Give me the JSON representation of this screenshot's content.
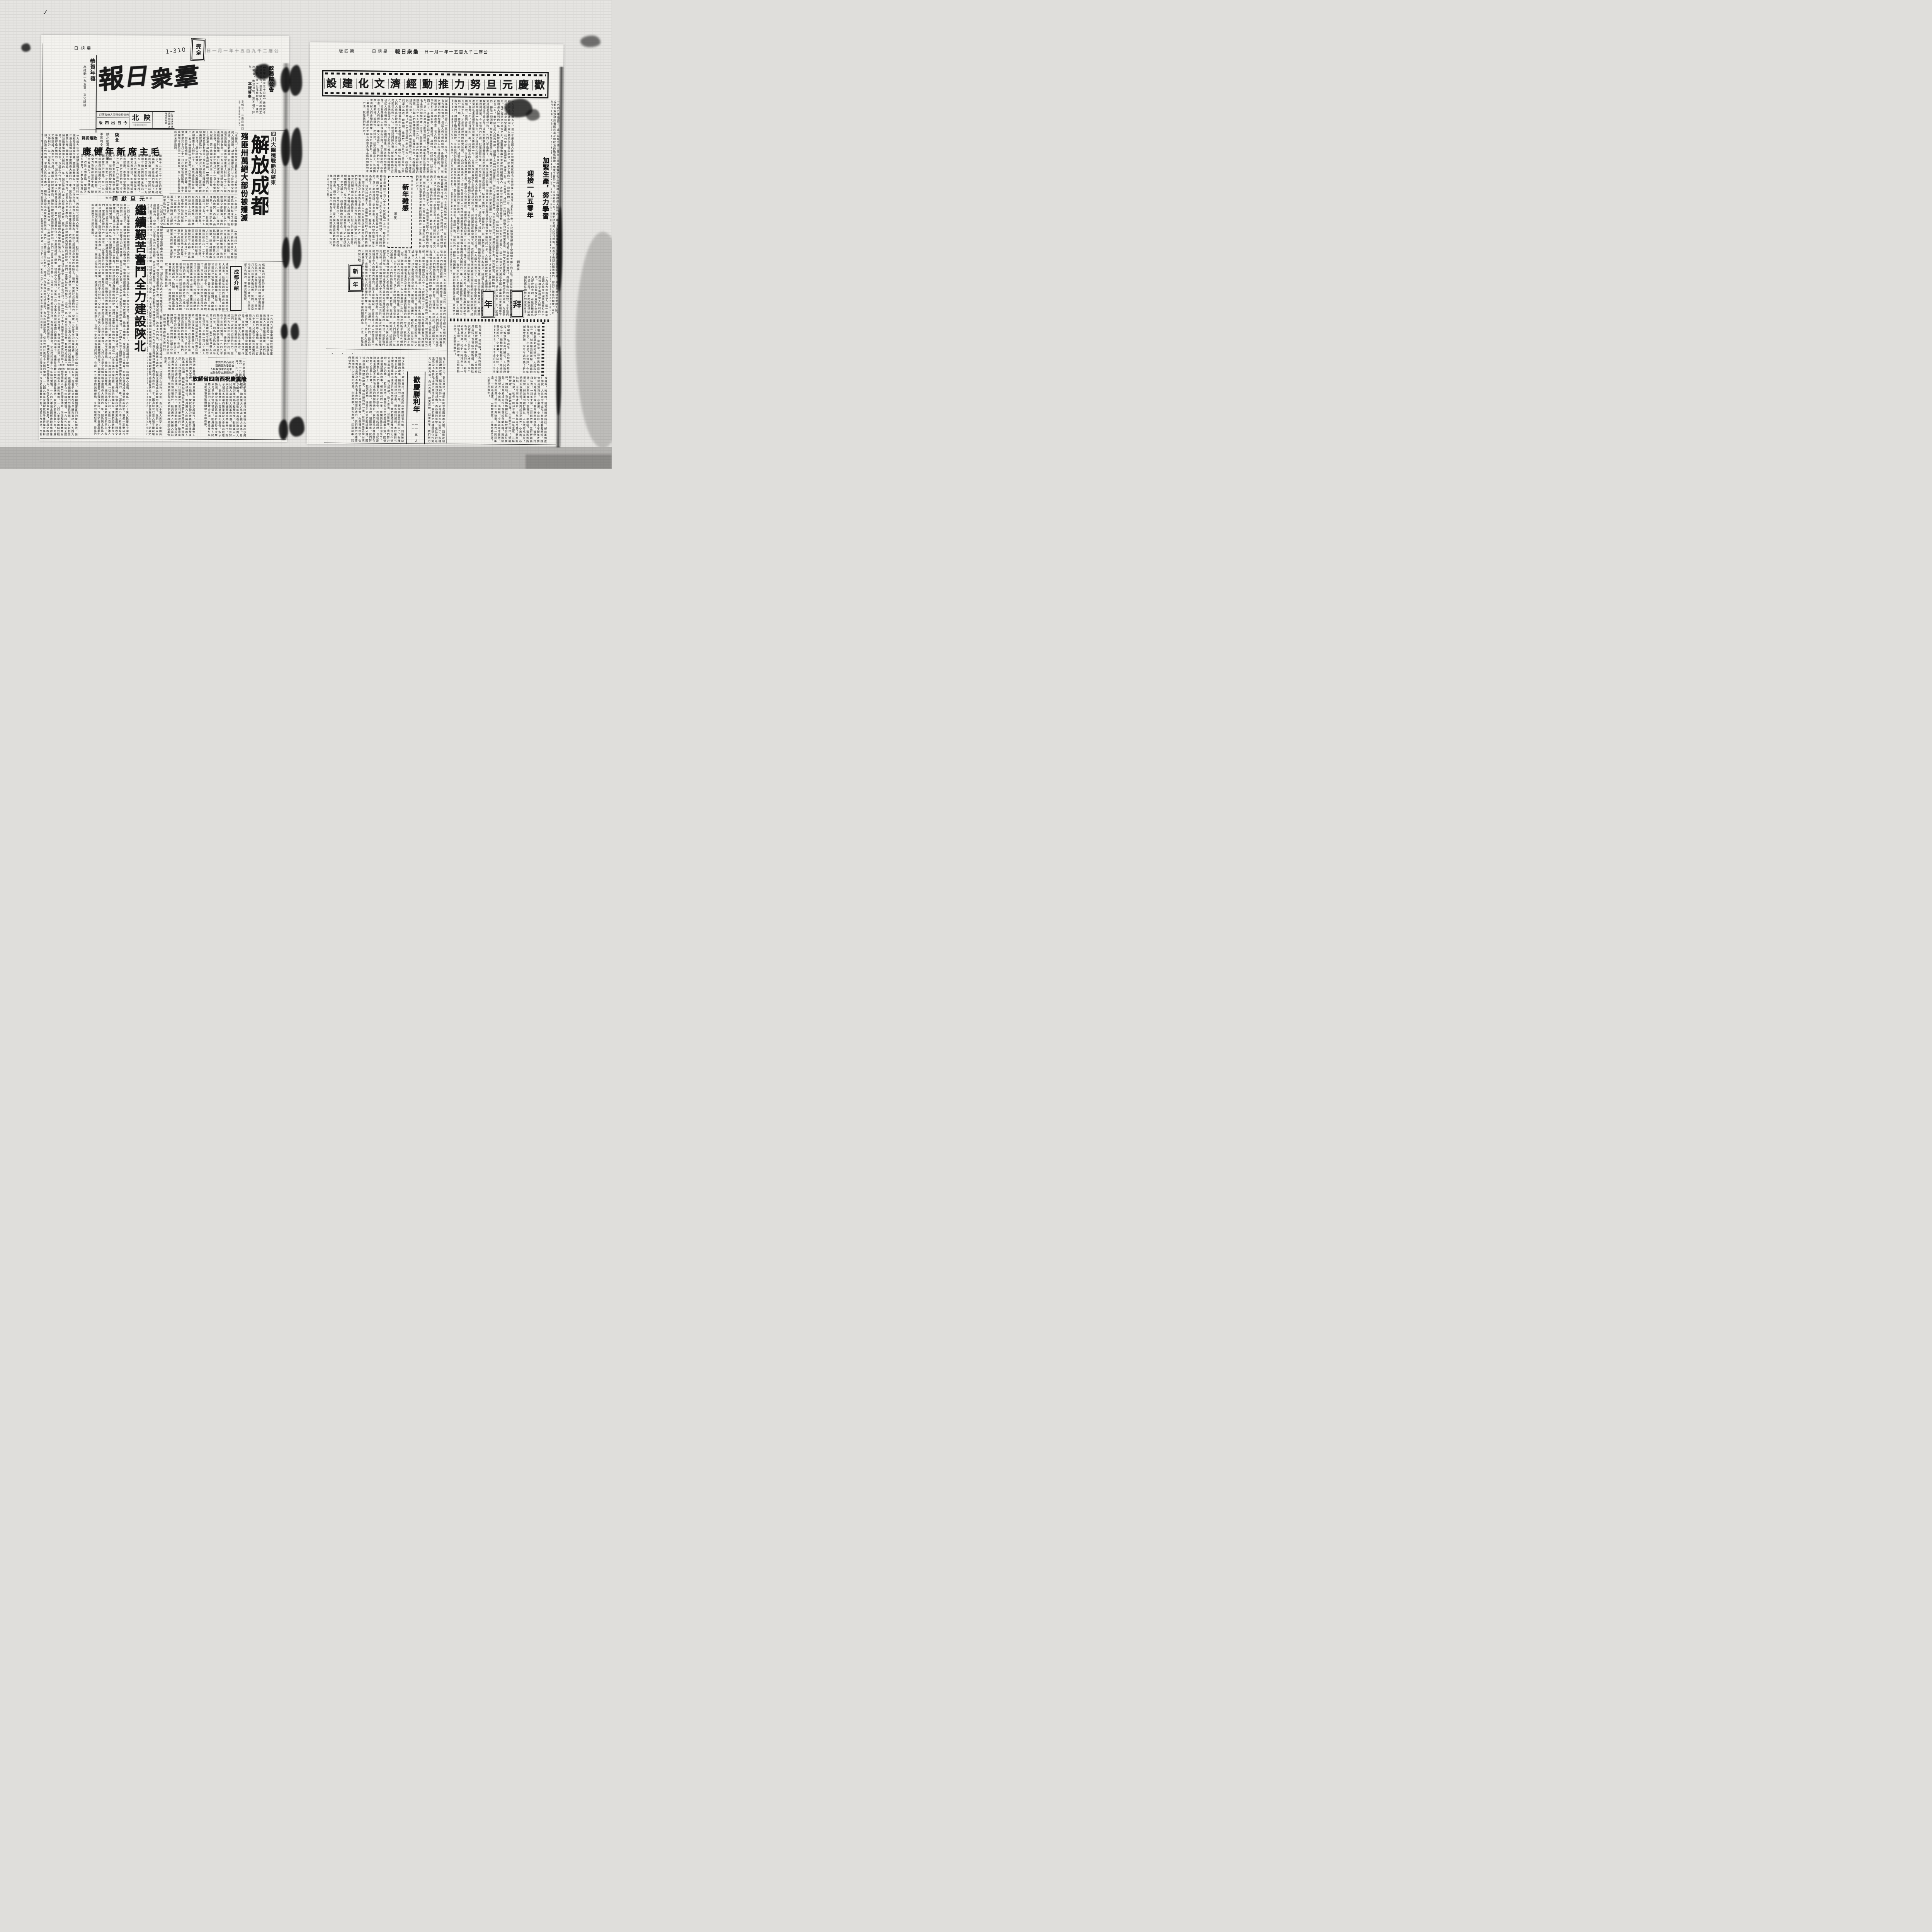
{
  "scan_marks": {
    "handwriting": "1-310",
    "stamp": "完全",
    "weekday": "星期日",
    "date_faint": "公曆二千九百五十年一月一日",
    "corner_mark": "✓",
    "cross_marks": "×　×　×"
  },
  "right_header": {
    "edition": "第四版",
    "weekday": "星期日",
    "paper": "羣衆日報",
    "date": "公曆二千九百五十年一月一日"
  },
  "masthead": {
    "title": "羣衆日報",
    "price": "訂價每份人民幣叁拾伍元",
    "edition_note": "今日出四版",
    "region": "陝北",
    "region_sub": "（羣衆日報社）",
    "info": "訂閱及廣告費另照郵局轉各地郵局辦理"
  },
  "greeting": {
    "line1": "恭賀年禧",
    "line2": "為推動一九五零、文化建設"
  },
  "gov_notice": {
    "title": "政務院公告",
    "body": "【新華社北京三十日電】政務院今日發佈公告，規定各級人民政府工作人員，在元旦除放假外，一律不許宴會，收送禮物，並不相互拜年。"
  },
  "paper_notice": {
    "title": "本報啓事",
    "body": "本報三、二兩日共四版，四日照常出版。"
  },
  "chengdu": {
    "kicker": "四川大圍殲戰勝利結束",
    "subtitle": "殘匪卅萬絕大部份被殲滅",
    "headline": "解放成都",
    "body": "【本報訊】人民解放軍已勝利結束了成都地區的大殲滅戰。胡宗南匪部已於廿七日被我全部殲滅，第四野戰軍一部沿川康公路向雅安、西昌方面進擊，匪首胡宗南本人則於二十三日乘飛機逃往台北。二十五日我軍開始總攻擊，西南戰役勝利結束，即日解放成都。守敵紛紛放下武器，裴昌會率部於本月二十一日在金堂地區起義，第十兵團司令部及四十一軍軍長、四十七軍軍長與所部全部投誠。"
  },
  "chengdu_intro": {
    "title": "成都介紹",
    "body": "成都是四川省的省會，西南著名的大城市。匪留在四川的胡宗南匪部及其他國民黨部隊約三十萬，自本月九日以來先後起義、投誠，川南地區國民黨軍基本上被殲，西康南部亦告解放，雲南光復在即。"
  },
  "mao_greeting": {
    "org1": "陝北區黨委、行署",
    "org2": "軍區司令部",
    "action": "致電祝賀",
    "headline": "毛主席新年健康",
    "body": "頃接十二月二十六日的覆電指示，我們都感到有說不出的高興，並給我們增加了無窮的力量。我們一定將以保持艱苦奮鬥的作風，在一九五零年動員與組織全陝北一百八十萬人民和全體幹部，首先全力恢復和發展生產，開展文教建設，加強幹部教育，改進工作作風，來回答您的鼓勵，不辜負您寶貴的指示，符合您的期望。"
  },
  "editorial": {
    "kicker": "元旦獻詞",
    "ornament": "※※",
    "headline": "繼續艱苦奮鬥全力建設陝北",
    "body": "一九四九年是全國解放戰爭獲得偉大勝利的一年。因為陝北已進入和平建設環境，戰鬥動員基本停止，生產建設成了壓倒一切的中心任務。全區一百八十萬人民要在中國共產黨的領導下，繼續發揚艱苦奮鬥的優良傳統，恢復和發展農業生產，開展文教建設，改進工作作風，鞏固人民民主專政，把陝北建設成為繁榮的新陝北。我們一定要以百倍的努力，完成一九五零年的光榮任務，有效的組織起來，使我們的計劃在今年勝利實現。"
  },
  "southwest": {
    "org1": "中共中央西南局",
    "org2": "西南軍政委員會",
    "org3": "人民解放軍西南軍區",
    "org4": "聯合發出慶祝指示",
    "headline": "隆重慶祝西南四省解放",
    "intro": "【新華社重慶三十日電】一九四九年十二月，川、康、滇、黔四省相繼解放，解放大西南的戰役即將勝利結束。中共中央西南局、西南軍政委員會和中國人民解放軍西南軍區為慶祝這一偉大勝利，特於二十七日聯合發出慶祝西南解放的指示。",
    "body": "指示號召各地舉行隆重慶祝大會和示威遊行，動員廣大人民進行擴大宣傳。指示指出，慶祝活動的意義在於激發廣大羣衆的革命熱情和積極性，動員廣大人民捲入當前的人民革命浪潮，積極參加與協助軍事管制機關建立革命秩序。"
  },
  "banner": {
    "text": "歡慶元旦努力推動經濟文化建設"
  },
  "lead_article": {
    "headline1": "加緊生產，努力學習",
    "headline2": "迎接一九五零年",
    "author": "劉壽亭",
    "body": "一九四九年過去了。這一年是全國人民在中國共產黨和毛主席領導下獲得偉大勝利的一年。人民解放軍解放了全國絕大部分的土地，蔣匪幫被逐出中國大陸，成都的解放標誌着國民黨反動統治的徹底崩潰。結束了舊的一年，迎接新的一年，我們陝北的人民和幹部，經過了長期的艱苦奮鬥，得到了徹底的解放。今年我們的任務，就是加緊生產，努力學習，鞏固勝利，團結一致，協同各界，掃除一切困難，恢復和發展農業生產，開展文化教育建設，用實際行動來迎接一九五零年。除了經濟文化建設之外，還要吸收廣大羣衆性的組織加入，才能完成我們的歷史任務。"
  },
  "zagan": {
    "title": "新年雜感",
    "author": "澤民",
    "body": "新年是每隔三百六十五天就要過一次的。每次的新年都有各種的情景，引起人們各種的感想、各種的想像。而各種的感想和想像，也就隨着各人的環境而不同。見了面總是說：恭喜恭喜！老人們想的是一年又過去了，孩子們盼的是穿新衣、戴新帽、放爆竹、吃好的。話又說回來了，各種情景引起人們各種的想像，而今年的新年，是人民大衆真正歡喜的新年。感謝毛主席及不辜負毛主席的關懷的唯一方法，就是我們努力吧！"
  },
  "bainian": {
    "char1": "拜",
    "char2": "年",
    "poem": "噯嚨嚀，哈哈哈，我和媽媽把話拉：解放軍到處打勝仗，人民政府成立啦！爸爸給我戴新帽，媽媽給我穿新衣，小弟弟，小妹妹，今年新年才算新，今年年過的美；新年新年真快樂，咱們一同拜年去：一拜毛主席，二拜解放軍，三拜勞動英雄，大家新年進步！"
  },
  "victory": {
    "title": "歡慶勝利年",
    "byline": "——五人——",
    "body": "除夕的晚上，歡天喜地，機關的同志們圍繞着火爐，回憶被胡匪蹂躪的故事，暢談勝利的一年。新聞談話又說回來了，各種情景引起人們各種的感想和想像。而各種的感想，也就是對毛主席及不辜負毛主席的關懷的表白。我們要把這種感想化作努力生產的力量，向北而歌，歡天喜地，迎接新年。我們努力吧！"
  },
  "small_section": {
    "char1": "新",
    "char2": "年"
  },
  "credits": {
    "line1": "工作者・編輯部",
    "line2": "計劃稿・資料組"
  }
}
